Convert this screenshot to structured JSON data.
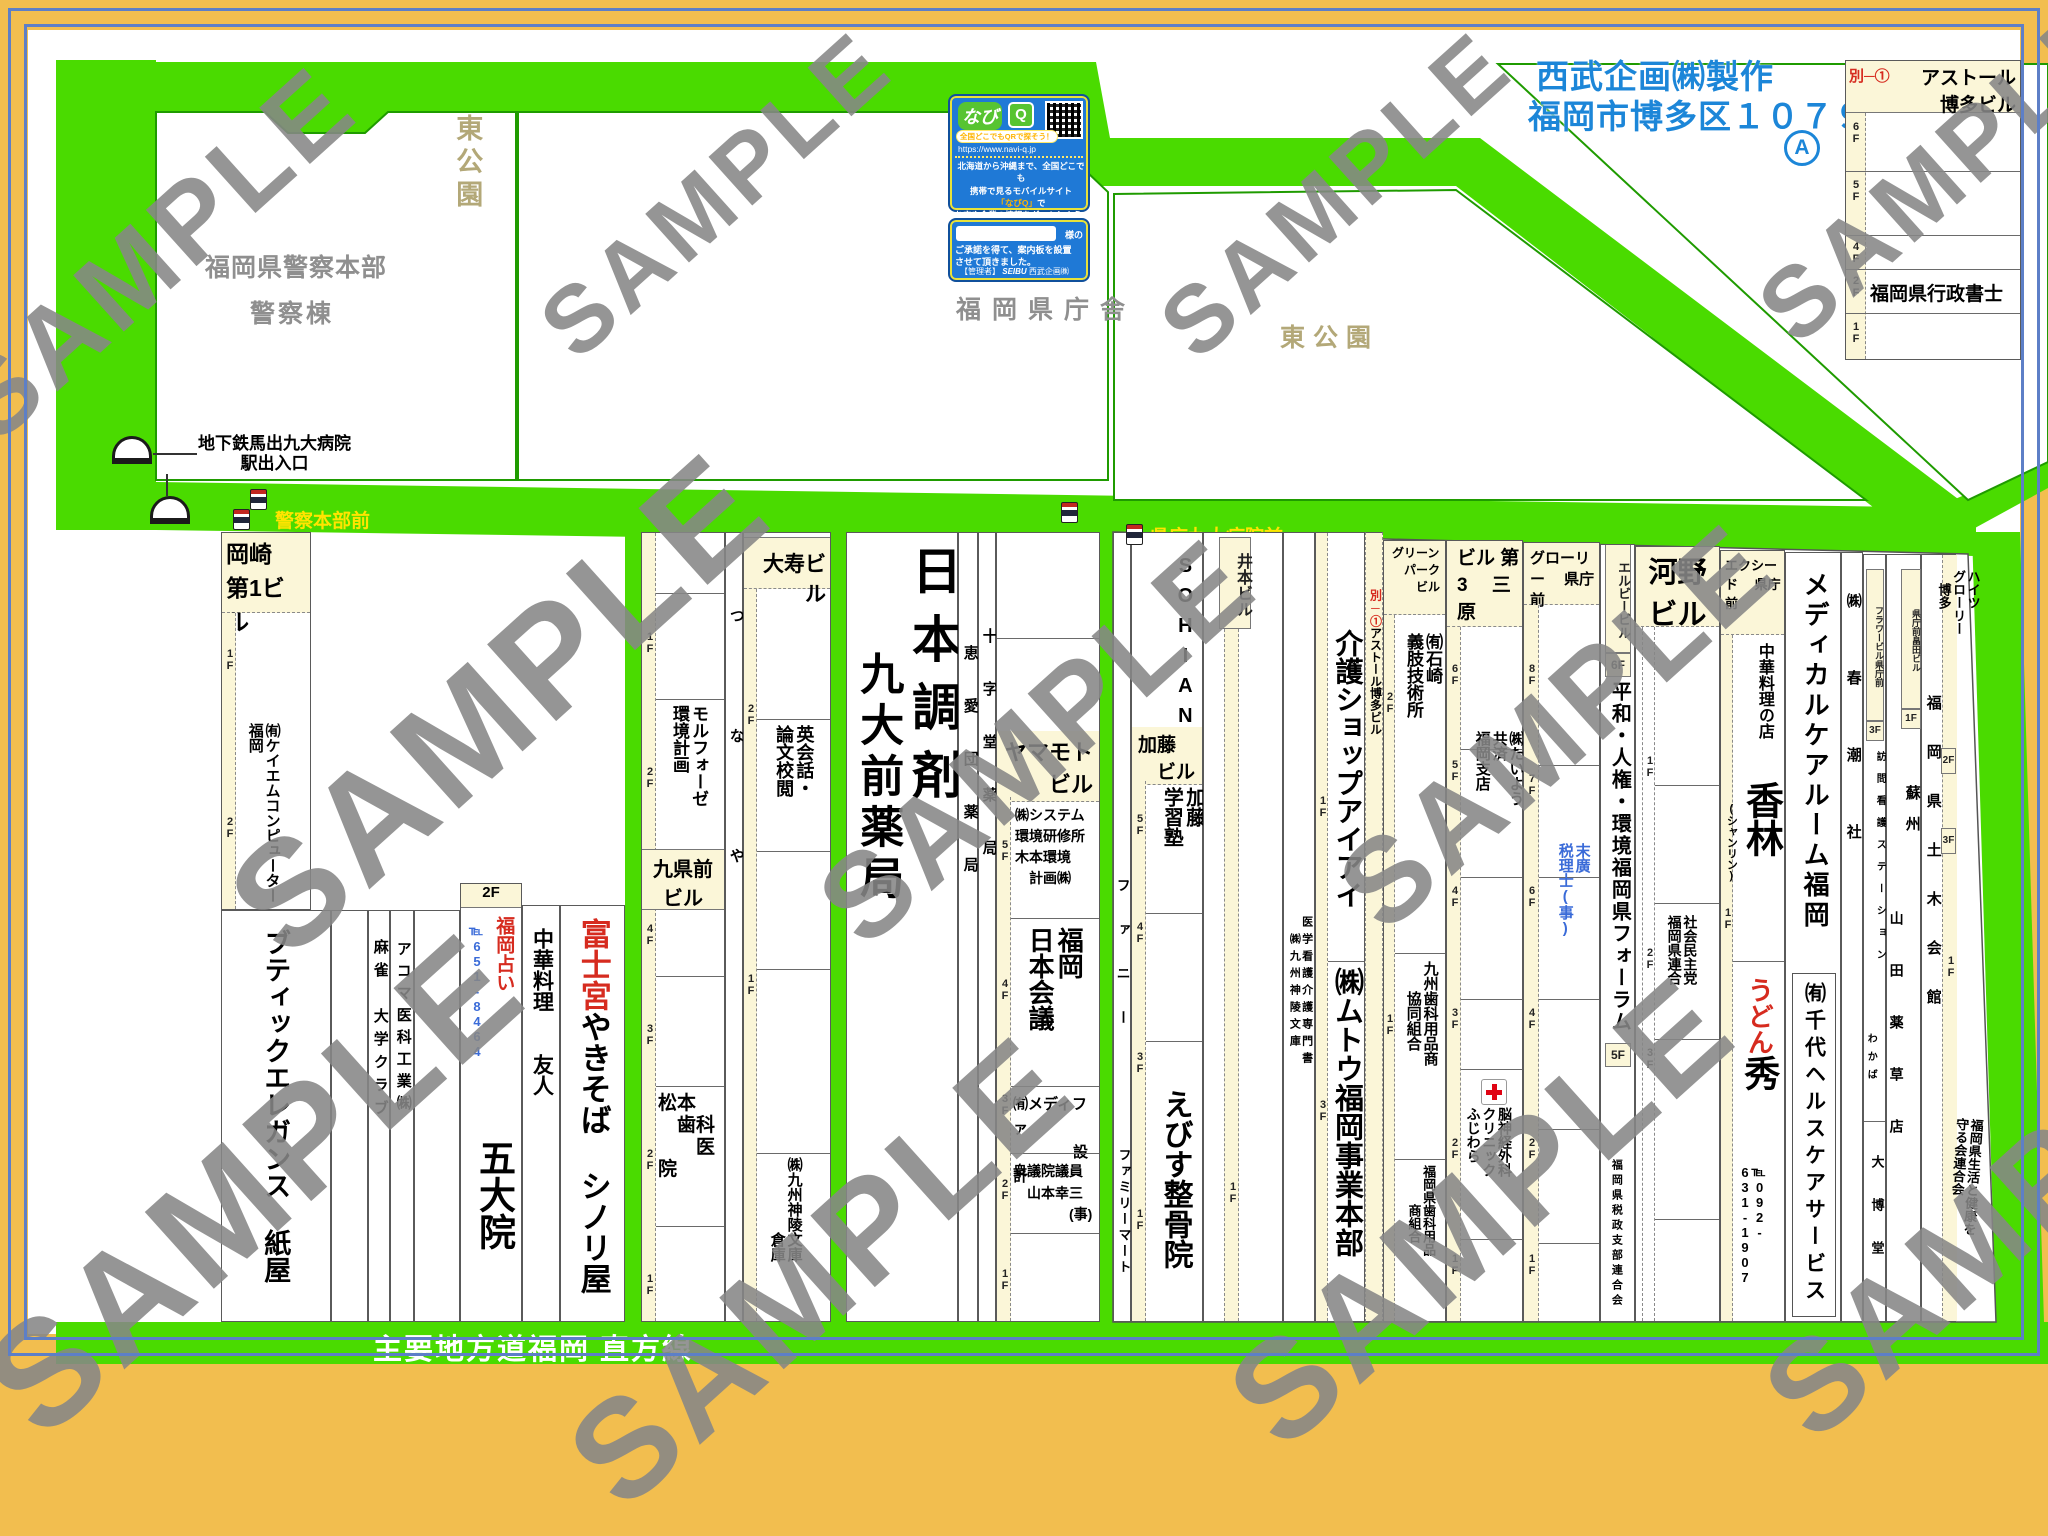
{
  "wm": "SAMPLE",
  "header": {
    "maker1": "西武企画㈱製作",
    "maker2": "福岡市博多区１０７９",
    "mark": "A"
  },
  "legend": {
    "ref": "別─①",
    "name": "アストール\n博多ビル",
    "tenant2f": "福岡県行政書士"
  },
  "fl": {
    "f1": "1F",
    "f2": "2F",
    "f3": "3F",
    "f4": "4F",
    "f5": "5F",
    "f6": "6F",
    "f7": "7F",
    "f8": "8F"
  },
  "navi": {
    "logo": "なび",
    "logoq": "Q",
    "slogan": "全国どこでもQRで探そう！",
    "url": "https://www.navi-q.jp",
    "body1": "北海道から沖縄まで、全国どこでも",
    "body2": "携帯で見るモバイルサイト",
    "body3a": "「なびQ」",
    "body3b": "で",
    "body4": "お店や企業の情報をグットしよう!!",
    "sama": "様の",
    "note1": "ご承諾を得て、案内板を設置",
    "note2": "させて頂きました。",
    "admin": "【管理者】",
    "seibu": "SEIBU",
    "adminco": "西武企画㈱"
  },
  "area": {
    "park1": "東公園",
    "park2": "東公園",
    "police1": "福岡県警察本部",
    "police2": "警察棟",
    "pref": "福岡県庁舎",
    "subway": "地下鉄馬出九大病院\n駅出入口",
    "bus1": "警察本部前",
    "bus2": "県庁九大病院前",
    "roadlabel": "主要地方道福岡 直方線"
  },
  "b1": {
    "okazaki": "岡崎\n第1ビル",
    "kei": "㈲ケイエムコンピューター\n福岡",
    "boutique": "ブティックエレガンス 紙屋",
    "mahjong": "麻雀　大学クラブ",
    "acoma": "アコマ医科工業㈱",
    "uranai": "福岡占い",
    "tel1": "℡651-8464",
    "godaiin": "五大院",
    "chuka": "中華料理　　友人",
    "fuji_red": "富士宮",
    "fuji_rest": "やきそば シノリ屋"
  },
  "b2": {
    "kuken": "九県前\nビル",
    "morpho": "モルフォーゼ\n環境計画",
    "matsumoto": "松本\n　歯科\n　　医院",
    "tsunaya": "つなや",
    "daiju": "大寿ビル",
    "eikaiwa": "英会話・\n論文校閲",
    "soko": "㈱九州神陵文庫\n　　　　　倉庫"
  },
  "b3": {
    "chozai": "日本調剤",
    "kudai": "九大前薬局",
    "keiai": "恵愛団薬局",
    "juji": "十字堂薬局",
    "yamamoto": "ヤマモト\nビル",
    "sys": "㈱システム\n環境研修所\n木本環境\n　計画㈱",
    "kaigi": "福岡\n日本会議",
    "medifa": "㈲メディファ\n　　　　設計",
    "giin": "衆議院議員\n　山本幸三\n　　　　(事)"
  },
  "b4": {
    "sohian": "SOHIAN",
    "fanny": "ファニー",
    "famima": "ファミリーマート",
    "kato": "加藤\n　ビル",
    "katojuku": "加藤\n学習塾",
    "ebisu": "えびす整骨院",
    "imoto": "井本ビル",
    "igaku": "医学看護介護専門書\n　㈱九州神陵文庫",
    "kaigo": "介護ショップアイアイ",
    "mutou": "㈱ムトウ福岡事業本部",
    "astor_ref": "別─①",
    "astor_name": "アストール博多ビル",
    "green": "グリーン\n　パーク\n　　ビル",
    "ishizaki": "㈲石崎\n義肢技術所",
    "kyushushika": "九州歯科用品商\n　　協同組合",
    "fukushika": "福岡県歯科用品\n　　　商組合",
    "mihara": "ビル\n第3\n　三原",
    "taiyo": "㈱たいよう\n共済\n福岡支店",
    "nou": "脳神経外科\nクリニック\nふじわら",
    "glory": "グローリー\n　県庁前",
    "suehiro": "末廣\n税理士(事)",
    "lb": "エルビービル",
    "heiwa": "平和・人権・環境福岡県フォーラム",
    "zeisei": "福岡県税政支部連合会",
    "kono": "河野\nビル",
    "shamin": "社会民主党\n福岡県連合",
    "exceed": "エクシード\n　県庁前",
    "chukaten": "中華料理の店",
    "kourin": "香林",
    "shanrin": "(シャンリン)",
    "udon": "うどん",
    "hide": "秀",
    "tel2": "℡092-\n631-1907",
    "medical": "メディカルケアルーム福岡",
    "chiyo": "㈲千代ヘルスケアサービス",
    "shuncho": "㈱春潮社",
    "flower": "フラワービル県庁前",
    "homon": "訪問看護ステーション",
    "wakaba": "わかば",
    "daihaku": "大博堂",
    "hatakeda": "県庁前畠田ビル",
    "soshu": "蘇州",
    "yamada": "山田薬草店",
    "doboku": "福岡県土木会館",
    "heights": "ハイツ\nグローリー\n　博多",
    "mamoru": "福岡県生活と健康を\n守る会連合会"
  }
}
